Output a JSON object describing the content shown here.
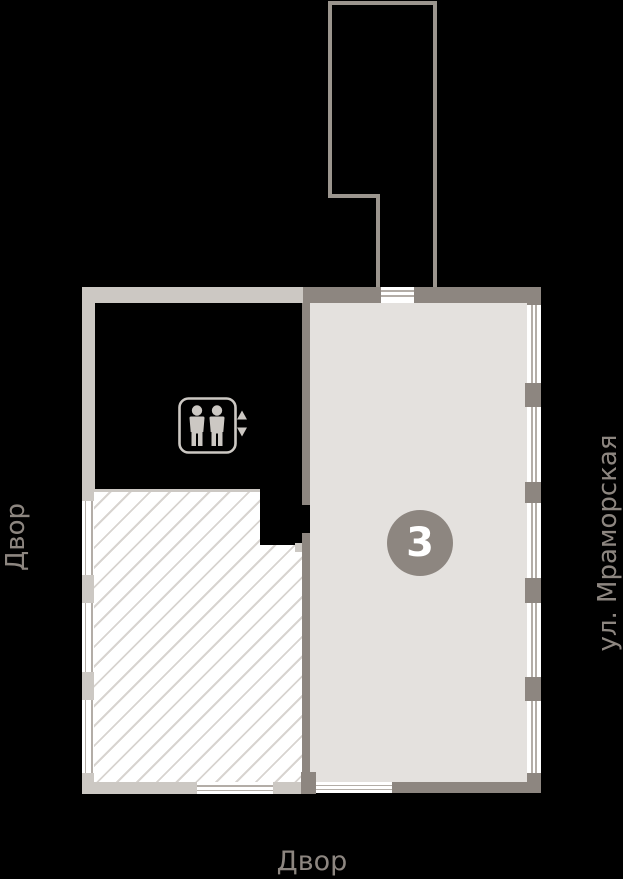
{
  "plan": {
    "unit_badge": "3",
    "labels": {
      "courtyard_left": "Двор",
      "courtyard_bottom": "Двор",
      "street_right": "ул. Мраморская"
    },
    "icons": {
      "elevator": "elevator-icon",
      "arrow_up": "arrow-up-icon",
      "arrow_down": "arrow-down-icon"
    },
    "colors": {
      "background": "#000000",
      "wall_light": "#ccc8c3",
      "wall_dark": "#8d8680",
      "outline": "#9b958e",
      "unit_fill": "#e4e1de",
      "hatch_line": "#d8d4d0",
      "hatch_background": "#ffffff",
      "window_line": "#b3ada7",
      "badge_fill": "#8d8680",
      "badge_text": "#ffffff",
      "label_text": "#8d8680"
    }
  }
}
